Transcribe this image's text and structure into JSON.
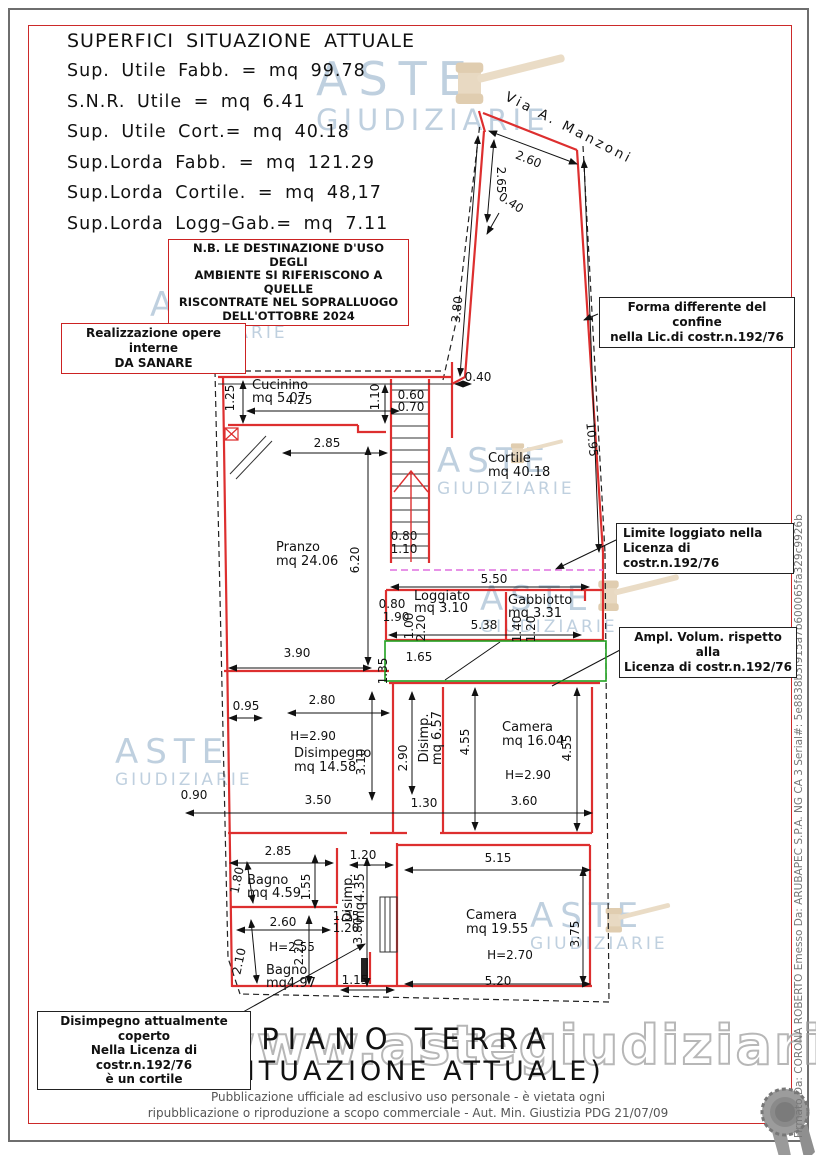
{
  "header": {
    "title": "SUPERFICI SITUAZIONE ATTUALE",
    "lines": [
      "Sup. Utile Fabb. = mq 99.78",
      "S.N.R. Utile = mq 6.41",
      "Sup. Utile Cort.= mq 40.18",
      "Sup.Lorda Fabb. = mq 121.29",
      "Sup.Lorda Cortile. = mq 48,17",
      "Sup.Lorda Logg–Gab.= mq 7.11"
    ]
  },
  "note_boxes": {
    "nb": {
      "lines": [
        "N.B. LE DESTINAZIONE D'USO DEGLI",
        "AMBIENTE SI RIFERISCONO A QUELLE",
        "RISCONTRATE NEL SOPRALLUOGO",
        "DELL'OTTOBRE 2024"
      ]
    },
    "opere": {
      "lines": [
        "Realizzazione opere interne",
        "DA SANARE"
      ]
    },
    "forma": {
      "lines": [
        "Forma differente del confine",
        "nella Lic.di costr.n.192/76"
      ]
    },
    "limite": {
      "lines": [
        "Limite loggiato nella",
        "Licenza di costr.n.192/76"
      ]
    },
    "ampl": {
      "lines": [
        "Ampl. Volum. rispetto alla",
        "Licenza di costr.n.192/76"
      ]
    },
    "coperto": {
      "lines": [
        "Disimpegno attualmente coperto",
        "Nella Licenza di costr.n.192/76",
        "è un cortile"
      ]
    }
  },
  "plan": {
    "street_label": "Via A. Manzoni",
    "rooms": [
      {
        "lines": [
          "Cucinino",
          "mq  5.07"
        ],
        "x": 252,
        "y": 389,
        "lh": 13
      },
      {
        "lines": [
          "Cortile",
          "mq  40.18"
        ],
        "x": 488,
        "y": 462,
        "lh": 14
      },
      {
        "lines": [
          "Pranzo",
          "mq  24.06"
        ],
        "x": 276,
        "y": 551,
        "lh": 14
      },
      {
        "lines": [
          "Loggiato",
          "mq  3.10"
        ],
        "x": 414,
        "y": 600,
        "lh": 12
      },
      {
        "lines": [
          "Gabbiotto",
          "mq  3.31"
        ],
        "x": 508,
        "y": 604,
        "lh": 13
      },
      {
        "lines": [
          "Disimpegno",
          "mq  14.58"
        ],
        "x": 294,
        "y": 757,
        "lh": 14
      },
      {
        "lines": [
          "Disimp.",
          "mq 6.57"
        ],
        "x": 428,
        "y": 738,
        "lh": 13,
        "r": -90,
        "anchor": "middle"
      },
      {
        "lines": [
          "Camera",
          "mq  16.04"
        ],
        "x": 502,
        "y": 731,
        "lh": 14
      },
      {
        "lines": [
          "Bagno",
          "mq  4.59"
        ],
        "x": 247,
        "y": 884,
        "lh": 13
      },
      {
        "lines": [
          "Disimp.",
          "mq4.35"
        ],
        "x": 352,
        "y": 898,
        "lh": 12,
        "r": -90,
        "anchor": "middle"
      },
      {
        "lines": [
          "Bagno",
          "mq4.97"
        ],
        "x": 266,
        "y": 974,
        "lh": 13
      },
      {
        "lines": [
          "Camera",
          "mq  19.55"
        ],
        "x": 466,
        "y": 919,
        "lh": 14
      }
    ],
    "dims": [
      {
        "t": "2.60",
        "x": 527,
        "y": 163,
        "r": 22
      },
      {
        "t": "2.65",
        "x": 497,
        "y": 180,
        "r": 90
      },
      {
        "t": "0.40",
        "x": 509,
        "y": 206,
        "r": 33
      },
      {
        "t": "3.80",
        "x": 461,
        "y": 310,
        "r": -84
      },
      {
        "t": "10.95",
        "x": 588,
        "y": 440,
        "r": 84
      },
      {
        "t": "0.40",
        "x": 478,
        "y": 381
      },
      {
        "t": "1.25",
        "x": 234,
        "y": 398,
        "r": -90
      },
      {
        "t": "4.25",
        "x": 299,
        "y": 404
      },
      {
        "t": "1.10",
        "x": 379,
        "y": 397,
        "r": -90
      },
      {
        "t": "0.60",
        "x": 411,
        "y": 399
      },
      {
        "t": "0.70",
        "x": 411,
        "y": 411
      },
      {
        "t": "2.85",
        "x": 327,
        "y": 447
      },
      {
        "t": "6.20",
        "x": 359,
        "y": 560,
        "r": -90
      },
      {
        "t": "0.80",
        "x": 404,
        "y": 540
      },
      {
        "t": "1.10",
        "x": 404,
        "y": 553
      },
      {
        "t": "5.50",
        "x": 494,
        "y": 583
      },
      {
        "t": "0.80",
        "x": 392,
        "y": 608
      },
      {
        "t": "1.90",
        "x": 396,
        "y": 621
      },
      {
        "t": "1.00",
        "x": 413,
        "y": 626,
        "r": -90
      },
      {
        "t": "2.20",
        "x": 425,
        "y": 628,
        "r": -90
      },
      {
        "t": "5.38",
        "x": 484,
        "y": 629
      },
      {
        "t": "1.40",
        "x": 521,
        "y": 629,
        "r": -90
      },
      {
        "t": "1.20",
        "x": 535,
        "y": 629,
        "r": -90
      },
      {
        "t": "1.65",
        "x": 419,
        "y": 661
      },
      {
        "t": "1.35",
        "x": 387,
        "y": 671,
        "r": -90
      },
      {
        "t": "3.90",
        "x": 297,
        "y": 657
      },
      {
        "t": "2.80",
        "x": 322,
        "y": 704
      },
      {
        "t": "0.95",
        "x": 246,
        "y": 710
      },
      {
        "t": "H=2.90",
        "x": 313,
        "y": 740
      },
      {
        "t": "3.10",
        "x": 365,
        "y": 762,
        "r": -90
      },
      {
        "t": "2.90",
        "x": 407,
        "y": 758,
        "r": -90
      },
      {
        "t": "4.55",
        "x": 469,
        "y": 742,
        "r": -90
      },
      {
        "t": "4.55",
        "x": 571,
        "y": 748,
        "r": -90
      },
      {
        "t": "H=2.90",
        "x": 528,
        "y": 779
      },
      {
        "t": "3.50",
        "x": 318,
        "y": 804
      },
      {
        "t": "1.30",
        "x": 424,
        "y": 807
      },
      {
        "t": "3.60",
        "x": 524,
        "y": 805
      },
      {
        "t": "0.90",
        "x": 194,
        "y": 799
      },
      {
        "t": "2.85",
        "x": 278,
        "y": 855
      },
      {
        "t": "1.20",
        "x": 363,
        "y": 859
      },
      {
        "t": "5.15",
        "x": 498,
        "y": 862
      },
      {
        "t": "1.80",
        "x": 241,
        "y": 881,
        "r": -78
      },
      {
        "t": "1.55",
        "x": 310,
        "y": 887,
        "r": -90
      },
      {
        "t": "1.35",
        "x": 346,
        "y": 920
      },
      {
        "t": "1.20",
        "x": 346,
        "y": 932
      },
      {
        "t": "3.80",
        "x": 362,
        "y": 931,
        "r": -90
      },
      {
        "t": "2.60",
        "x": 283,
        "y": 926
      },
      {
        "t": "H=2.55",
        "x": 292,
        "y": 951
      },
      {
        "t": "2.20",
        "x": 303,
        "y": 952,
        "r": -90
      },
      {
        "t": "2.10",
        "x": 243,
        "y": 962,
        "r": -78
      },
      {
        "t": "1.15",
        "x": 355,
        "y": 984
      },
      {
        "t": "5.20",
        "x": 498,
        "y": 985
      },
      {
        "t": "3.75",
        "x": 579,
        "y": 934,
        "r": -90
      },
      {
        "t": "H=2.70",
        "x": 510,
        "y": 959
      }
    ]
  },
  "titles": {
    "main": "PIANO TERRA",
    "sub": "(SITUAZIONE ATTUALE)"
  },
  "footer": {
    "line1": "Pubblicazione ufficiale ad esclusivo uso personale - è vietata ogni",
    "line2": "ripubblicazione o riproduzione a scopo commerciale - Aut. Min. Giustizia PDG 21/07/09"
  },
  "watermark": {
    "aste": "ASTE",
    "giudiziarie": "GIUDIZIARIE",
    "url": "www.astegiudiziarie.it"
  },
  "signature": "Firmato Da: CORONA ROBERTO Emesso Da: ARUBAPEC S.P.A. NG CA 3 Serial#: 5e8838b3f915a7b600065fa329c9926b",
  "colors": {
    "wall_red": "#dd2f2f",
    "frame_red": "#cc2a2a",
    "frame_gray": "#6e6e6e",
    "boundary_black": "#222222",
    "limite_magenta": "#df6fdf",
    "ampliamento_green": "#1fa11f",
    "watermark_blue": "#b5c8da",
    "gavel_beige": "#e8d9c2"
  }
}
